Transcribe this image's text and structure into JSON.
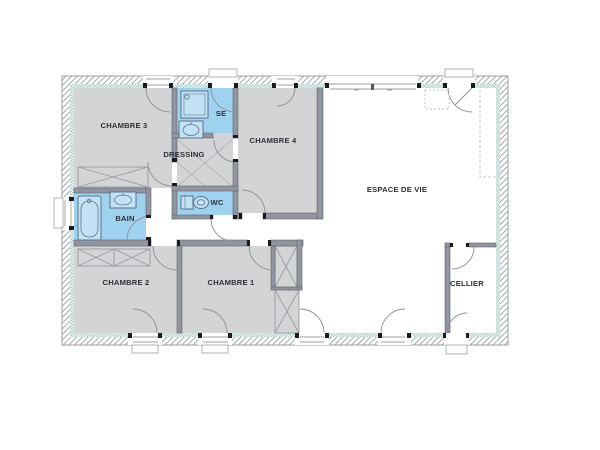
{
  "plan": {
    "rooms": [
      {
        "id": "chambre3",
        "label": "CHAMBRE 3"
      },
      {
        "id": "se",
        "label": "SE"
      },
      {
        "id": "dressing",
        "label": "DRESSING"
      },
      {
        "id": "chambre4",
        "label": "CHAMBRE 4"
      },
      {
        "id": "bain",
        "label": "BAIN"
      },
      {
        "id": "wc",
        "label": "WC"
      },
      {
        "id": "espace_de_vie",
        "label": "ESPACE DE VIE"
      },
      {
        "id": "chambre2",
        "label": "CHAMBRE 2"
      },
      {
        "id": "chambre1",
        "label": "CHAMBRE 1"
      },
      {
        "id": "cellier",
        "label": "CELLIER"
      }
    ],
    "colors": {
      "wet_room_fill": "#9fd2ee",
      "room_fill": "#d3d4d6",
      "wall_fill": "#9095a0",
      "insulation_tint": "#aed2cb",
      "hatch_line": "#a6a9ad",
      "door_arc": "#8d9096",
      "label_text": "#2e2f36",
      "fixture_line": "#5b7486",
      "fixture_fill": "#c2e3f5"
    }
  }
}
